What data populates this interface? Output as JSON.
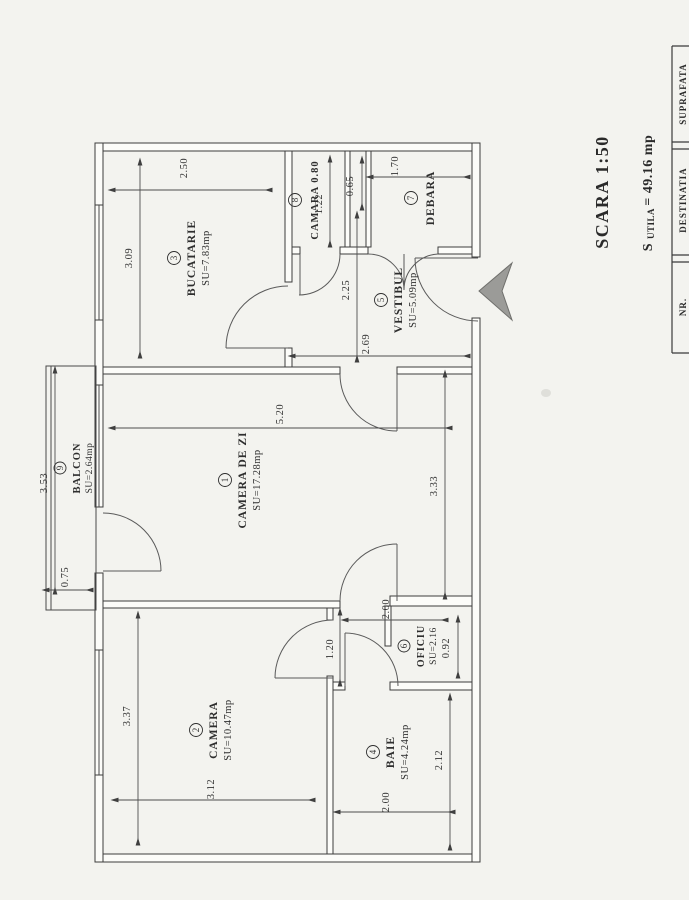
{
  "scale_label": "SCARA 1:50",
  "area_total": {
    "prefix": "S ",
    "sub": "UTILA ",
    "value": "= 49.16 mp"
  },
  "table_headers": {
    "col_nr": "NR.",
    "col_dest": "DESTINATIA",
    "col_supr": "SUPRAFATA"
  },
  "rooms": [
    {
      "num": "1",
      "name": "CAMERA DE ZI",
      "area": "SU=17.28mp"
    },
    {
      "num": "2",
      "name": "CAMERA",
      "area": "SU=10.47mp"
    },
    {
      "num": "3",
      "name": "BUCATARIE",
      "area": "SU=7.83mp"
    },
    {
      "num": "4",
      "name": "BAIE",
      "area": "SU=4.24mp"
    },
    {
      "num": "5",
      "name": "VESTIBUL",
      "area": "SU=5.09mp"
    },
    {
      "num": "6",
      "name": "OFICIU",
      "area": "SU=2.16"
    },
    {
      "num": "7",
      "name": "DEBARA",
      "area": ""
    },
    {
      "num": "8",
      "name": "CAMARA 0.80",
      "area": ""
    },
    {
      "num": "9",
      "name": "BALCON",
      "area": "SU=2.64mp"
    }
  ],
  "dims": {
    "bucatarie_w": "2.50",
    "bucatarie_h": "3.09",
    "camara_h": "1.22",
    "niche_w": "0.65",
    "debara_w": "1.70",
    "vestibul_h": "2.25",
    "vestibul_w": "2.69",
    "camera_zi_w": "5.20",
    "camera_zi_h": "3.33",
    "balcon_h": "3.53",
    "balcon_w": "0.75",
    "camera_h": "3.37",
    "camera_w": "3.12",
    "hall_h": "1.20",
    "oficiu_w": "2.00",
    "oficiu_h": "0.92",
    "baie_h": "2.12",
    "baie_w": "2.00"
  }
}
